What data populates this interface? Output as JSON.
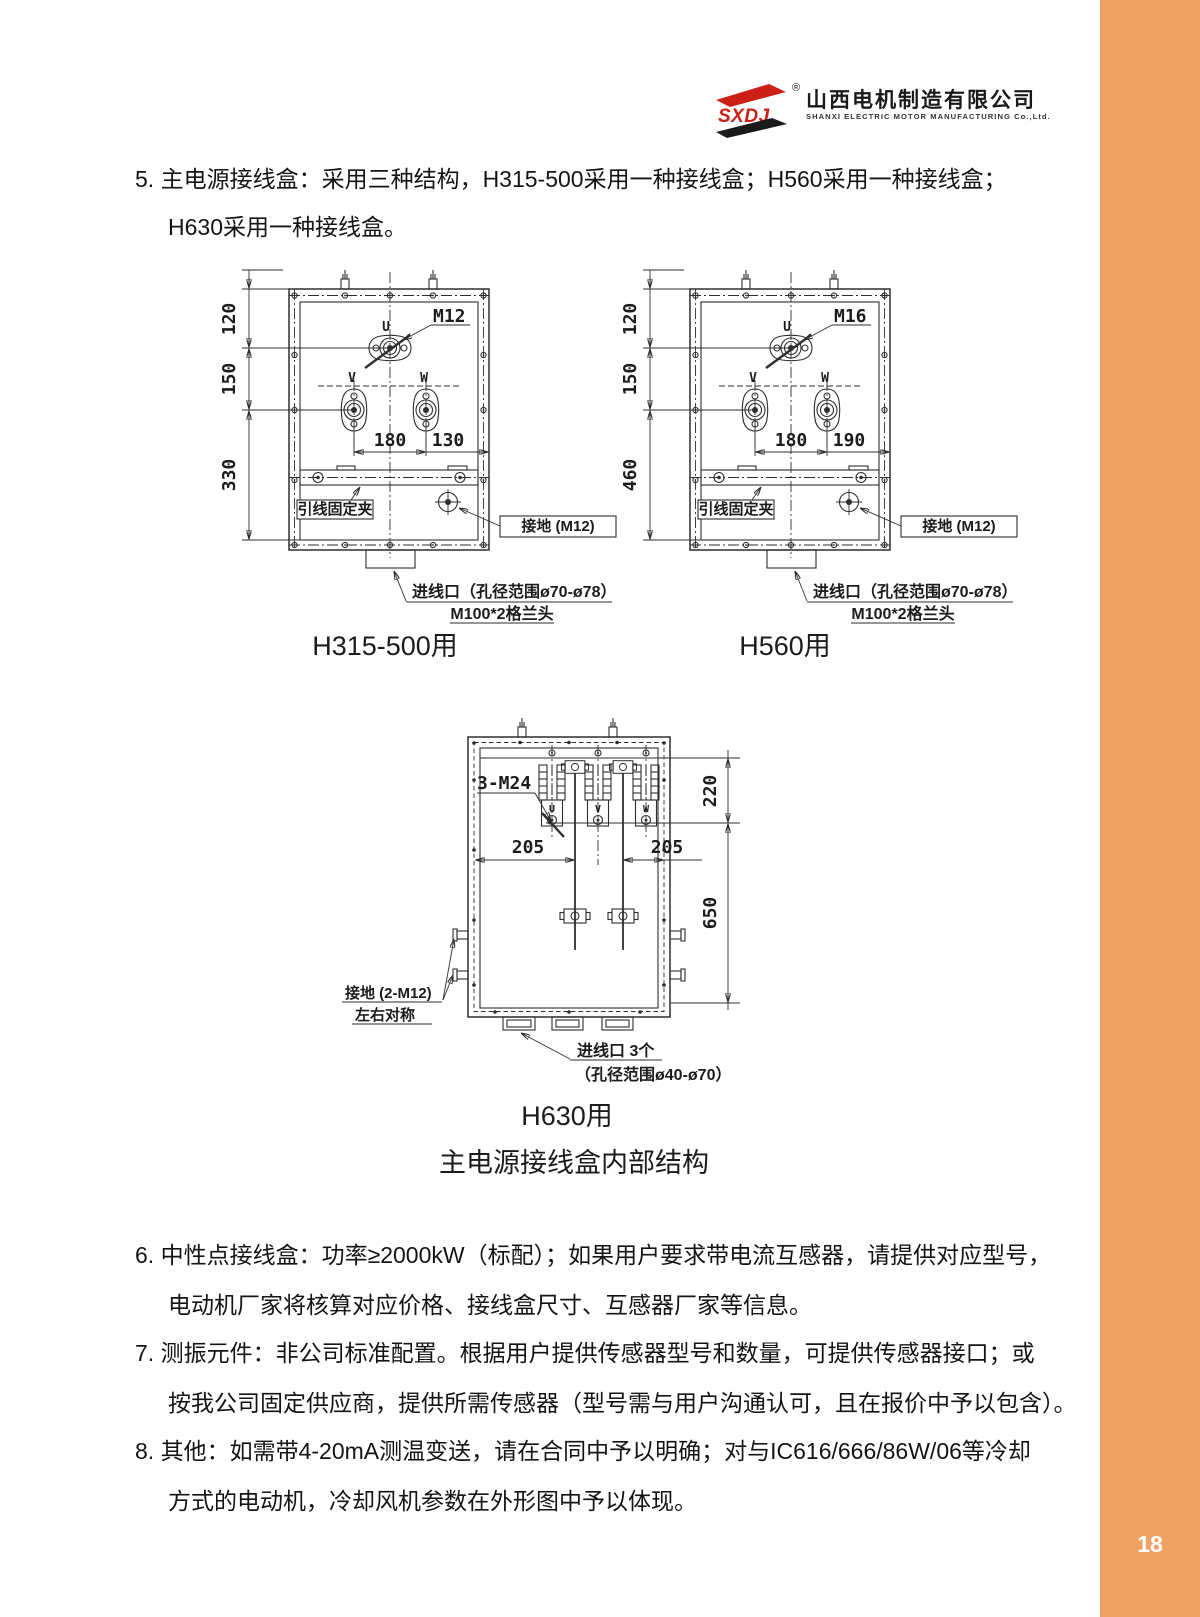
{
  "page": {
    "number": "18",
    "accent_orange": "#F0A262",
    "background": "#ffffff"
  },
  "header": {
    "logo_mark": "SXDJ",
    "logo_reg": "®",
    "company_cn": "山西电机制造有限公司",
    "company_en": "SHANXI ELECTRIC MOTOR MANUFACTURING Co.,Ltd."
  },
  "paragraphs": {
    "item5": {
      "line1": "5. 主电源接线盒：采用三种结构，H315-500采用一种接线盒；H560采用一种接线盒；",
      "line2": "H630采用一种接线盒。"
    },
    "item6": {
      "line1": "6. 中性点接线盒：功率≥2000kW（标配）；如果用户要求带电流互感器，请提供对应型号，",
      "line2": "电动机厂家将核算对应价格、接线盒尺寸、互感器厂家等信息。"
    },
    "item7": {
      "line1": "7. 测振元件：非公司标准配置。根据用户提供传感器型号和数量，可提供传感器接口；或",
      "line2": "按我公司固定供应商，提供所需传感器（型号需与用户沟通认可，且在报价中予以包含）。"
    },
    "item8": {
      "line1": "8. 其他：如需带4-20mA测温变送，请在合同中予以明确；对与IC616/666/86W/06等冷却",
      "line2": "方式的电动机，冷却风机参数在外形图中予以体现。"
    }
  },
  "figures": {
    "caption_a": "H315-500用",
    "caption_b": "H560用",
    "caption_c": "H630用",
    "title": "主电源接线盒内部结构",
    "a": {
      "thread": "M12",
      "u": "U",
      "v": "V",
      "w": "W",
      "dim1": "120",
      "dim2": "150",
      "dim3": "330",
      "dimh1": "180",
      "dimh2": "130",
      "clamp": "引线固定夹",
      "ground": "接地 (M12)",
      "inlet1": "进线口（孔径范围ø70-ø78）",
      "inlet2": "M100*2格兰头"
    },
    "b": {
      "thread": "M16",
      "u": "U",
      "v": "V",
      "w": "W",
      "dim1": "120",
      "dim2": "150",
      "dim3": "460",
      "dimh1": "180",
      "dimh2": "190",
      "clamp": "引线固定夹",
      "ground": "接地 (M12)",
      "inlet1": "进线口（孔径范围ø70-ø78）",
      "inlet2": "M100*2格兰头"
    },
    "c": {
      "thread": "3-M24",
      "u": "U",
      "v": "V",
      "w": "W",
      "dimh1": "205",
      "dimh2": "205",
      "dimv1": "220",
      "dimv2": "650",
      "ground1": "接地 (2-M12)",
      "ground2": "左右对称",
      "inlet1": "进线口 3个",
      "inlet2": "（孔径范围ø40-ø70）"
    }
  }
}
